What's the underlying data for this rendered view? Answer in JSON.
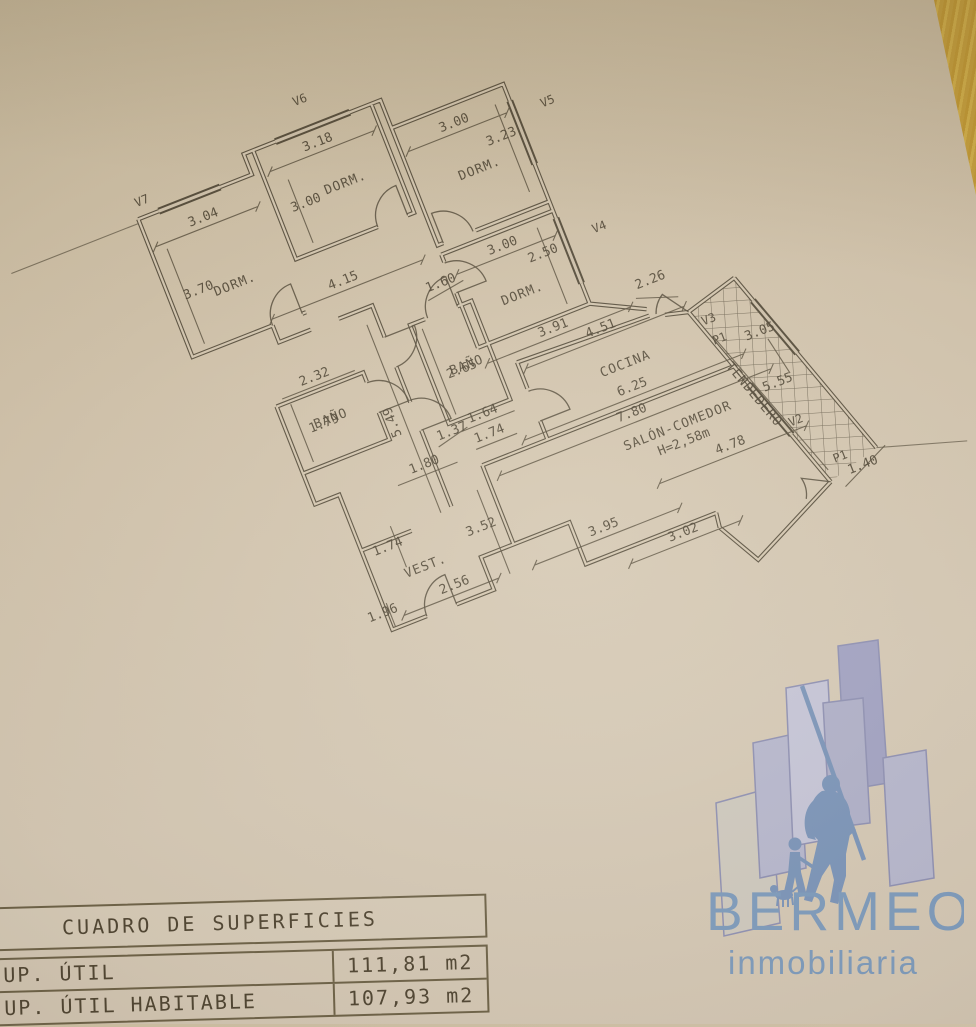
{
  "plan": {
    "windows": {
      "v7": "V7",
      "v6": "V6",
      "v5": "V5",
      "v4": "V4",
      "v3": "V3",
      "v2": "V2"
    },
    "doors": {
      "p1a": "P1",
      "p1b": "P1"
    },
    "rooms": {
      "dorm1": "DORM.",
      "dorm2": "DORM.",
      "dorm3": "DORM.",
      "dorm4": "DORM.",
      "bano1": "BAÑO",
      "bano2": "BAÑO",
      "cocina": "COCINA",
      "tendedero": "TENDEDERO",
      "salon": "SALÓN-COMEDOR",
      "salon_height": "H=2,58m",
      "vest": "VEST."
    },
    "dims": {
      "d304": "3.04",
      "d370": "3.70",
      "d318": "3.18",
      "d300a": "3.00",
      "d300b": "3.00",
      "d323": "3.23",
      "d300c": "3.00",
      "d250": "2.50",
      "d391": "3.91",
      "d160": "1.60",
      "d415": "4.15",
      "d549": "5.49",
      "d265": "2.65",
      "d164": "1.64",
      "d451": "4.51",
      "d226": "2.26",
      "d625": "6.25",
      "d174a": "1.74",
      "d555": "5.55",
      "d140": "1.40",
      "d305": "3.05",
      "d780": "7.80",
      "d478": "4.78",
      "d232": "2.32",
      "d179": "1.79",
      "d137": "1.37",
      "d180": "1.80",
      "d174b": "1.74",
      "d352": "3.52",
      "d196": "1.96",
      "d256": "2.56",
      "d395": "3.95",
      "d302": "3.02"
    }
  },
  "surfaces_table": {
    "title": "CUADRO DE SUPERFICIES",
    "rows": [
      {
        "label": "UP. ÚTIL",
        "value": "111,81 m2"
      },
      {
        "label": "UP. ÚTIL HABITABLE",
        "value": "107,93 m2"
      }
    ]
  },
  "logo": {
    "brand": "BERMEO",
    "subtitle": "inmobiliaria"
  },
  "colors": {
    "paper": "#d3c6af",
    "ink": "#554c3b",
    "accent_blue": "#7e9cbe",
    "building_purple": "#a9aac8",
    "wood_edge": "#c9a23e"
  }
}
